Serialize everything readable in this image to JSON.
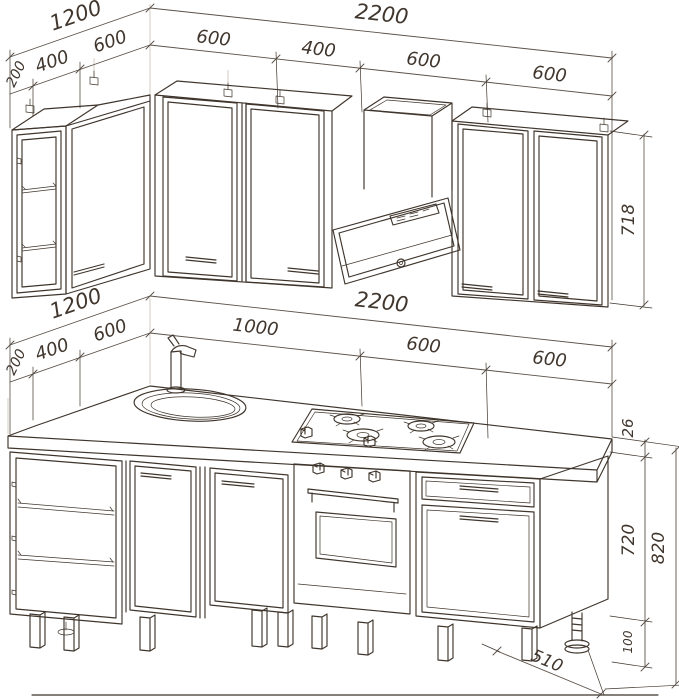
{
  "document": {
    "title": "Kitchen set technical drawing",
    "units_note": "mm"
  },
  "palette": {
    "line": "#3f352c",
    "dim": "#5b5148",
    "light": "#c9c0b7",
    "background": "#ffffff"
  },
  "wall_cabinets_view": {
    "left_run": {
      "total": "1200",
      "segments": [
        "200",
        "400",
        "600"
      ]
    },
    "right_run": {
      "total": "2200",
      "segments": [
        "600",
        "400",
        "600",
        "600"
      ]
    },
    "cabinet_height": "718",
    "items": [
      "glass-door display cabinet",
      "corner wall cabinet",
      "single-door cabinet",
      "single-door cabinet",
      "angled cooker hood with duct",
      "two-door cabinet"
    ]
  },
  "base_cabinets_view": {
    "left_run": {
      "total": "1200",
      "segments": [
        "200",
        "400",
        "600"
      ]
    },
    "right_run": {
      "total": "2200",
      "segments": [
        "1000",
        "600",
        "600"
      ]
    },
    "worktop_thickness": "26",
    "carcass_height": "720",
    "overall_height": "820",
    "leg_height": "100",
    "depth": "510",
    "items": [
      "open shelf cabinet",
      "corner sink cabinet with mixer tap",
      "door cabinet",
      "gas hob",
      "built-in oven",
      "drawer and door cabinet",
      "adjustable feet"
    ]
  }
}
